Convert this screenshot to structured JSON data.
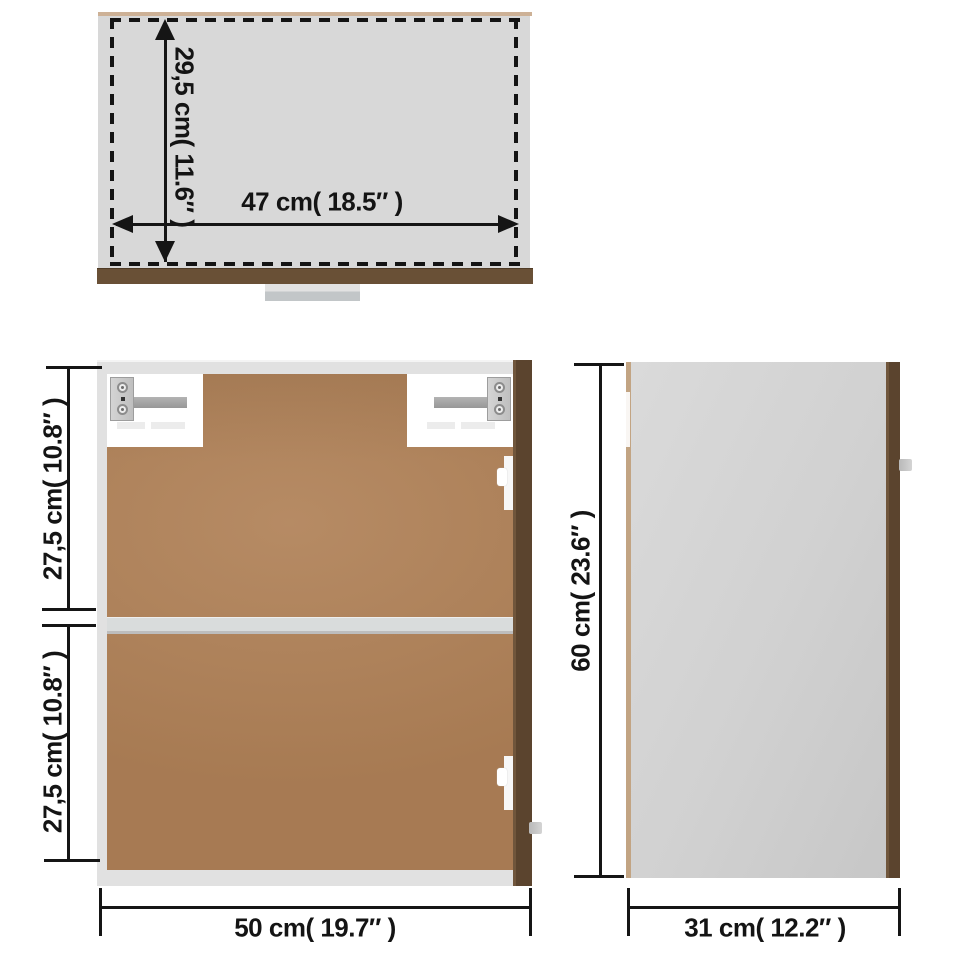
{
  "diagram": {
    "subject": "wall-cabinet-dimension-diagram",
    "views": {
      "top": {
        "name": "top-view",
        "depth_label": "29,5 cm( 11.6″ )",
        "width_label": "47 cm( 18.5″ )"
      },
      "front": {
        "name": "front-view",
        "upper_height_label": "27,5 cm( 10.8″ )",
        "lower_height_label": "27,5 cm( 10.8″ )",
        "width_label": "50 cm( 19.7″ )"
      },
      "side": {
        "name": "side-view",
        "height_label": "60 cm( 23.6″ )",
        "depth_label": "31 cm( 12.2″ )"
      }
    },
    "colors": {
      "background": "#ffffff",
      "dimension_ink": "#151515",
      "top_panel_gray": "#d8d8d8",
      "frame_gray": "#e1e1e1",
      "back_panel_brown": "#b08157",
      "door_edge_dark_brown": "#5b442e",
      "wood_edge_tan": "#c2a483",
      "handle_gray": "#c2c6c8",
      "side_panel_gray": "#d1d1d1"
    }
  }
}
